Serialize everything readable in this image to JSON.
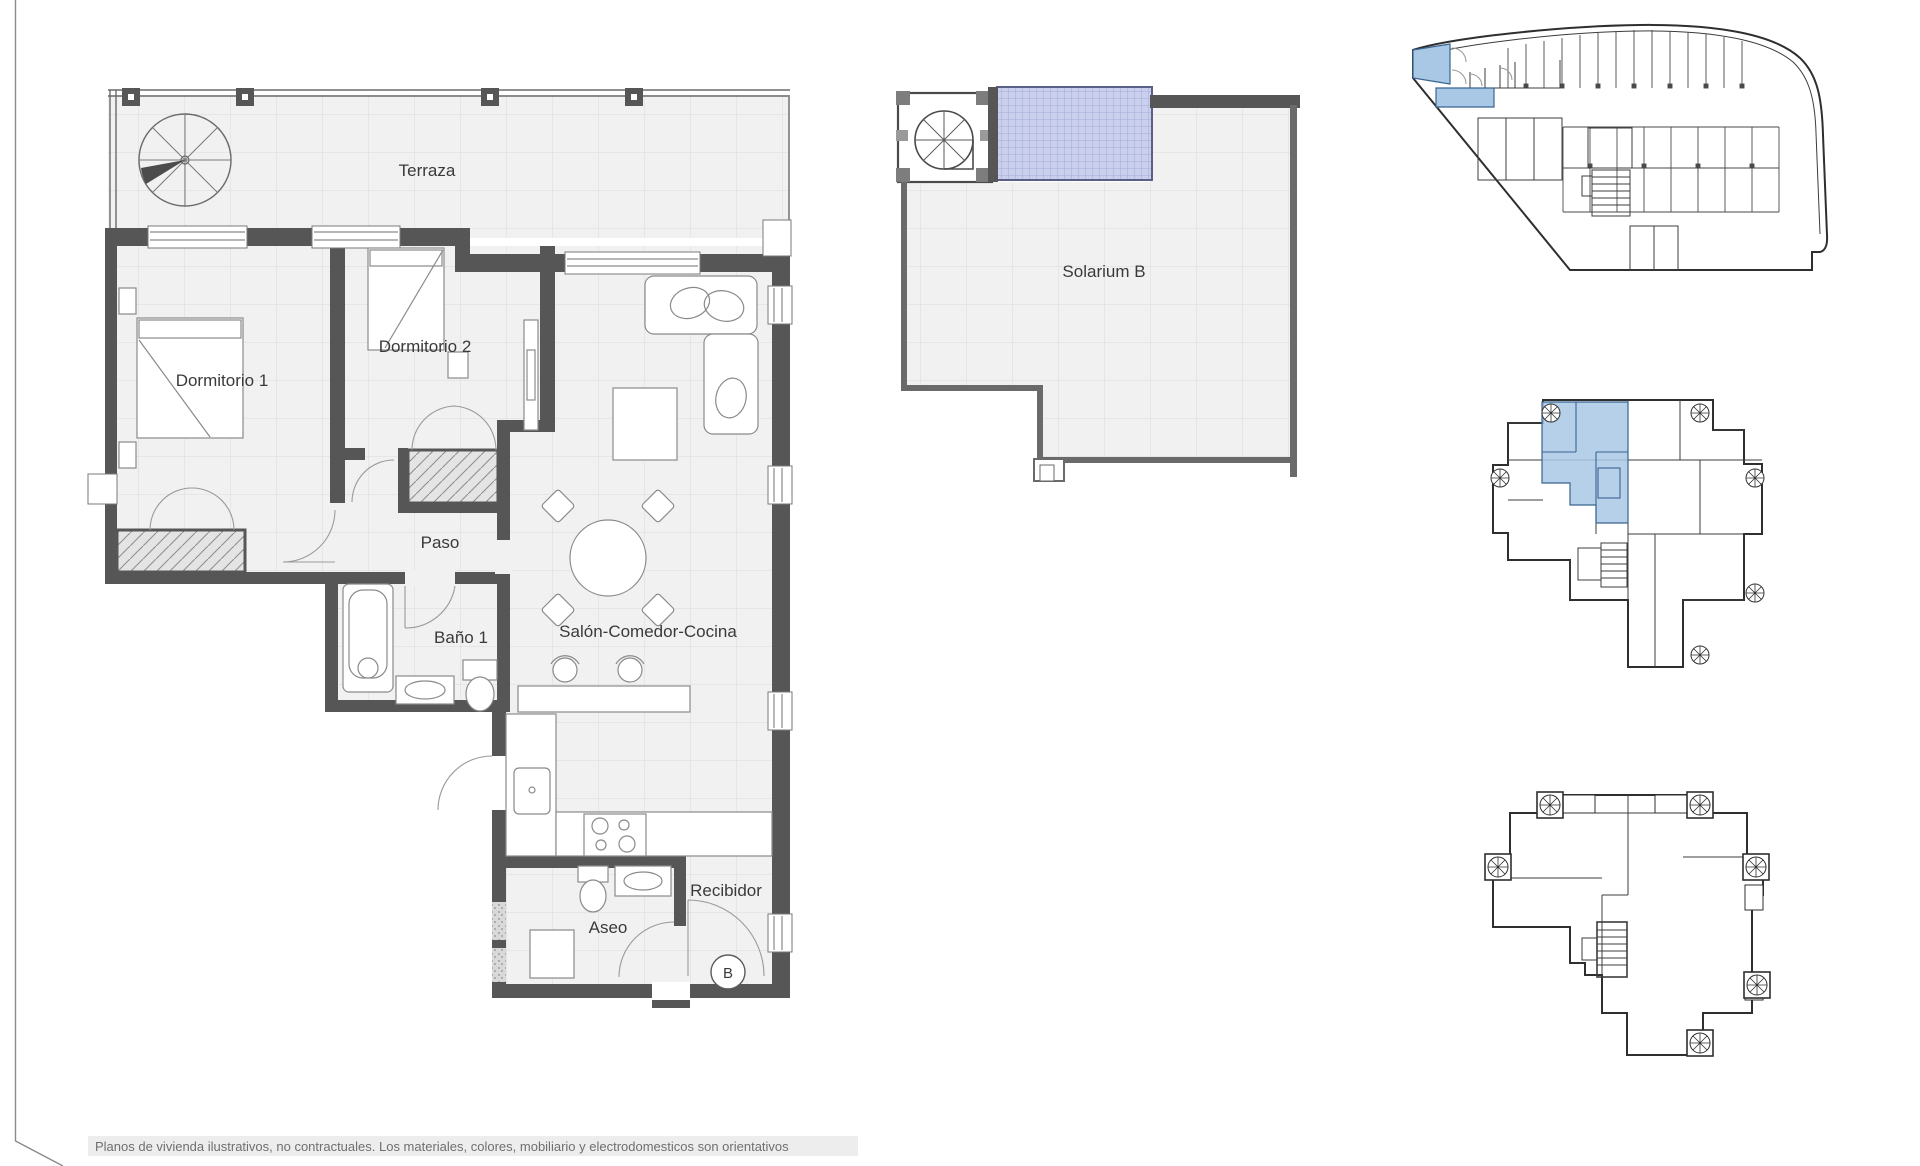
{
  "sheet": {
    "disclaimer": "Planos de vivienda ilustrativos, no contractuales. Los materiales, colores, mobiliario y electrodomesticos son orientativos"
  },
  "main_plan": {
    "rooms": {
      "terraza": "Terraza",
      "dormitorio_1": "Dormitorio 1",
      "dormitorio_2": "Dormitorio 2",
      "paso": "Paso",
      "bano_1": "Baño 1",
      "salon_comedor_cocina": "Salón-Comedor-Cocina",
      "aseo": "Aseo",
      "recibidor": "Recibidor"
    },
    "unit_marker": "B"
  },
  "solarium_plan": {
    "label": "Solarium B"
  },
  "colors": {
    "wall": "#565656",
    "floor": "#f1f1f1",
    "floor-grid": "#dbdbdb",
    "line": "#6b6b6b",
    "text": "#3a3a3a",
    "muted": "#6f6f6f",
    "highlight": "#a9c8e6",
    "pergola": "#c9cfec",
    "pergola-grid": "#99a3cf",
    "hatch-bg": "#e4e4e4",
    "hatch-line": "#8f8f8f"
  }
}
